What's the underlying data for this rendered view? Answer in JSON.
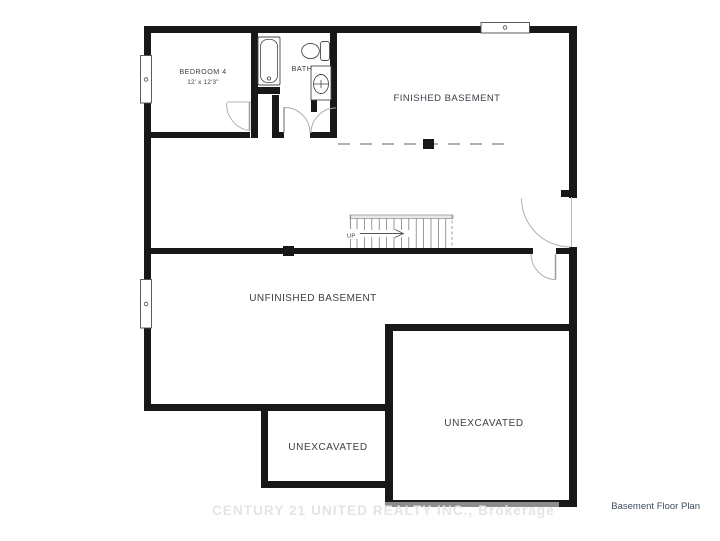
{
  "floor_plan": {
    "rooms": {
      "bedroom4": {
        "name": "BEDROOM 4",
        "dimensions": "12' x 12'3\""
      },
      "bath": {
        "name": "BATH"
      },
      "finished_basement": {
        "name": "FINISHED BASEMENT"
      },
      "unfinished_basement": {
        "name": "UNFINISHED BASEMENT"
      },
      "unexcavated_small": {
        "name": "UNEXCAVATED"
      },
      "unexcavated_large": {
        "name": "UNEXCAVATED"
      }
    },
    "stairs": {
      "direction_label": "UP"
    }
  },
  "footer": {
    "watermark": "CENTURY 21 UNITED REALTY INC., Brokerage",
    "plan_title": "Basement Floor Plan"
  },
  "colors": {
    "wall": "#181818",
    "label_text": "#3a3f47",
    "watermark_text": "#e4e4e4",
    "plan_title_text": "#3e4a5e",
    "door_swing": "#a8a8a8",
    "fixture_outline": "#4a4a4a"
  }
}
